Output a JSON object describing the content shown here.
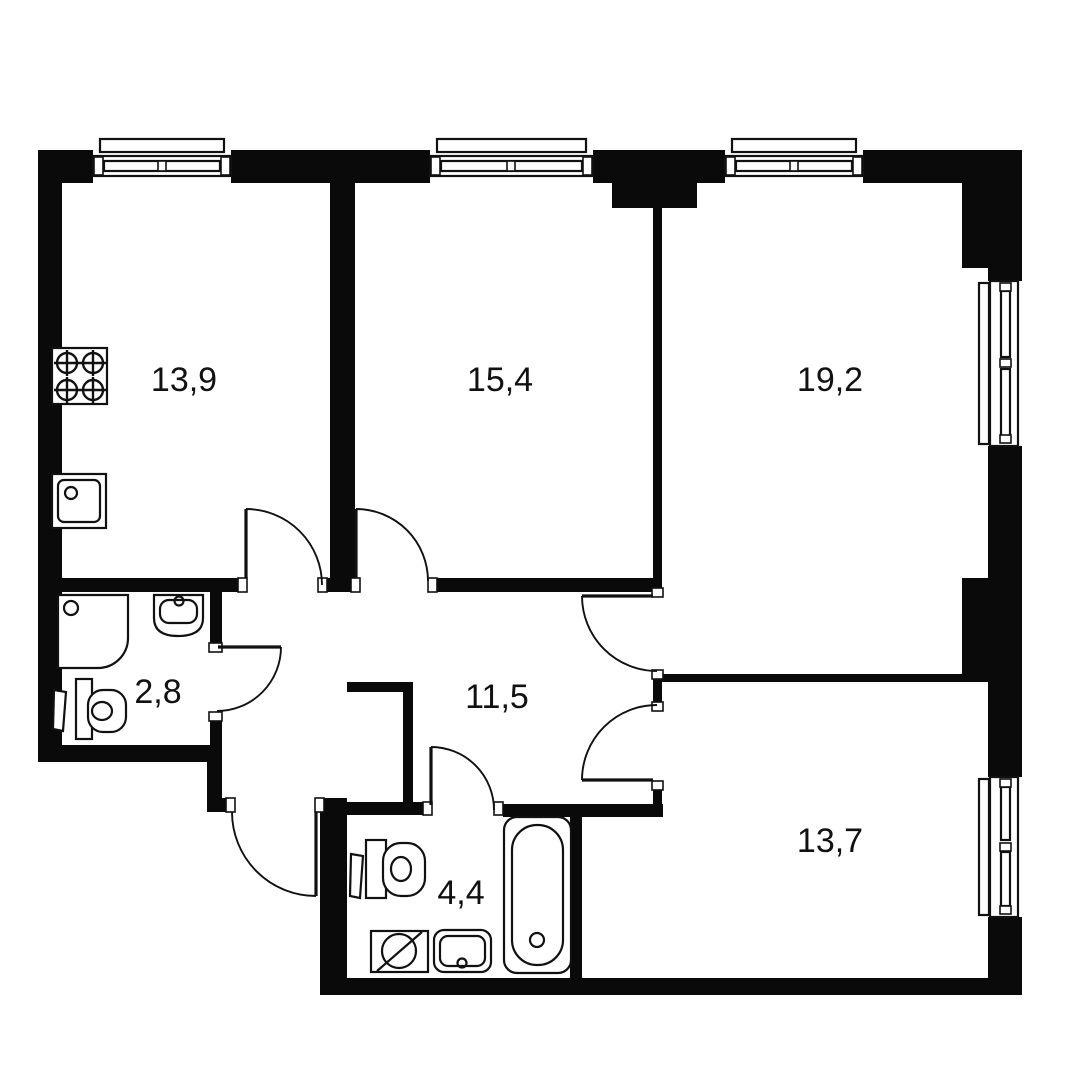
{
  "plan": {
    "kind": "apartment-floor-plan",
    "colors": {
      "background": "#ffffff",
      "walls": "#0a0a0a",
      "lines": "#111111"
    },
    "rooms": [
      {
        "id": "kitchen",
        "area": "13,9",
        "fixtures": [
          "stove",
          "sink"
        ]
      },
      {
        "id": "room-middle",
        "area": "15,4",
        "fixtures": []
      },
      {
        "id": "room-right",
        "area": "19,2",
        "fixtures": []
      },
      {
        "id": "shower-wc",
        "area": "2,8",
        "fixtures": [
          "shower",
          "washbasin",
          "toilet",
          "towel-rail"
        ]
      },
      {
        "id": "hallway",
        "area": "11,5",
        "fixtures": []
      },
      {
        "id": "bathroom",
        "area": "4,4",
        "fixtures": [
          "toilet",
          "towel-rail",
          "washing-machine",
          "washbasin",
          "bathtub"
        ]
      },
      {
        "id": "room-bottom",
        "area": "13,7",
        "fixtures": []
      }
    ]
  }
}
